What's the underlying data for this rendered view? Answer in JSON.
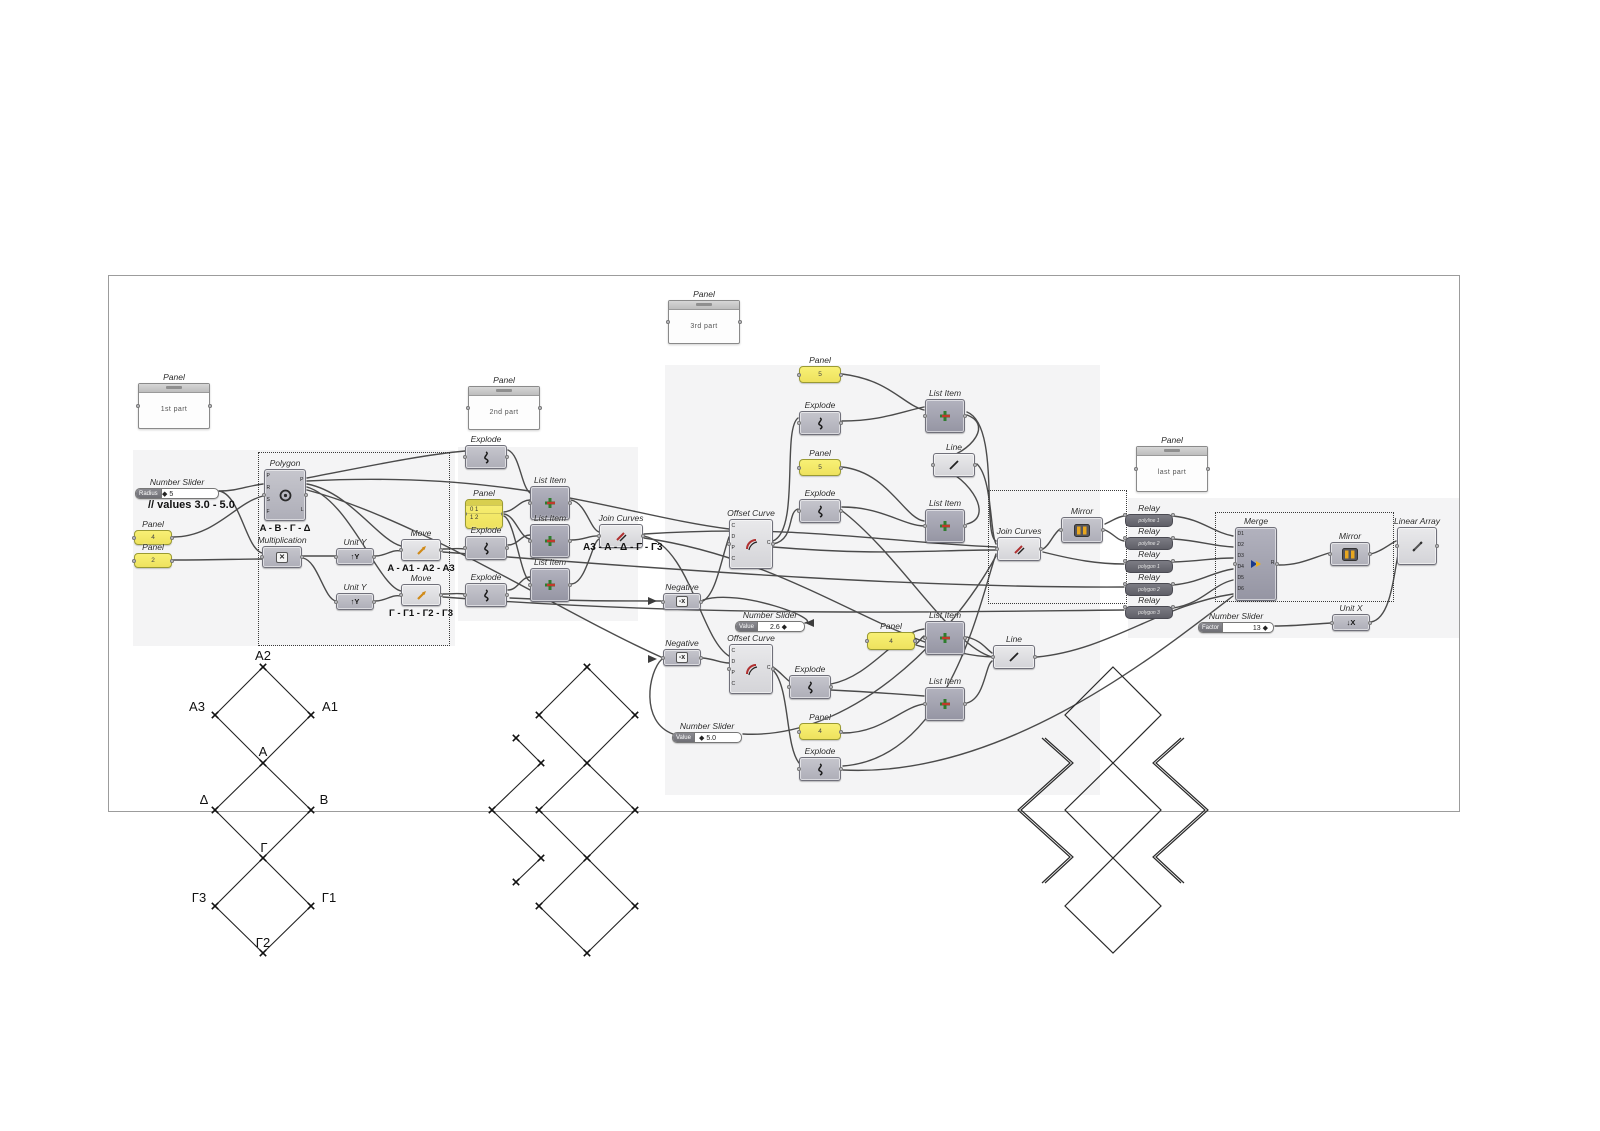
{
  "shared": {
    "panel": "Panel",
    "number_slider": "Number Slider",
    "explode": "Explode",
    "list_item": "List Item",
    "join_curves": "Join Curves",
    "offset_curve": "Offset Curve",
    "negative": "Negative",
    "line": "Line",
    "mirror": "Mirror",
    "relay": "Relay",
    "merge": "Merge",
    "linear_array": "Linear Array",
    "unit_y": "Unit Y",
    "unit_x": "Unit X",
    "move": "Move",
    "polygon": "Polygon",
    "multiplication": "Multiplication"
  },
  "panels": {
    "first": {
      "text": "1st part"
    },
    "second": {
      "text": "2nd part"
    },
    "third": {
      "text": "3rd part"
    },
    "last": {
      "text": "last part"
    }
  },
  "sliders": {
    "radius": {
      "grip": "Radius",
      "value": "◆ 5"
    },
    "offset_top": {
      "grip": "Value",
      "value": "2.6 ◆"
    },
    "offset_bottom": {
      "grip": "Value",
      "value": "◆ 5.0"
    },
    "factor": {
      "grip": "Factor",
      "value": "13 ◆"
    }
  },
  "yellow_panels": {
    "a": "4",
    "b": "2",
    "top": "5",
    "mid": "5",
    "low": "4",
    "bottom": "4",
    "list_rows": [
      "0 1",
      "1 2"
    ]
  },
  "annotations": {
    "values_comment": "// values 3.0 - 5.0",
    "polygon_label": "A - B - Γ - Δ",
    "move1_label": "A - A1 - A2 - A3",
    "move2_label": "Γ - Γ1 - Γ2 - Γ3",
    "join_label": "A3 - A - Δ - Γ - Γ3"
  },
  "relays": {
    "r1": "polyline 1",
    "r2": "polyline 2",
    "r3": "polygon 1",
    "r4": "polygon 2",
    "r5": "polygon 3"
  },
  "ports": {
    "merge_in": [
      "D1",
      "D2",
      "D3",
      "D4",
      "D5",
      "D6"
    ],
    "merge_out": "R",
    "offset_in": [
      "C",
      "D",
      "P",
      "C"
    ],
    "offset_out": "C",
    "polygon_in": [
      "P",
      "R",
      "S",
      "F"
    ],
    "polygon_out": [
      "P",
      "L"
    ]
  },
  "icons": {
    "unit_y": "↑Y",
    "unit_x": "↓X",
    "multiplication": "✕",
    "negative": "-x"
  },
  "diagram_labels": {
    "a2": "A2",
    "a3": "A3",
    "a1": "A1",
    "a": "A",
    "delta": "Δ",
    "b": "B",
    "gamma": "Γ",
    "g3": "Γ3",
    "g1": "Γ1",
    "g2": "Γ2"
  }
}
